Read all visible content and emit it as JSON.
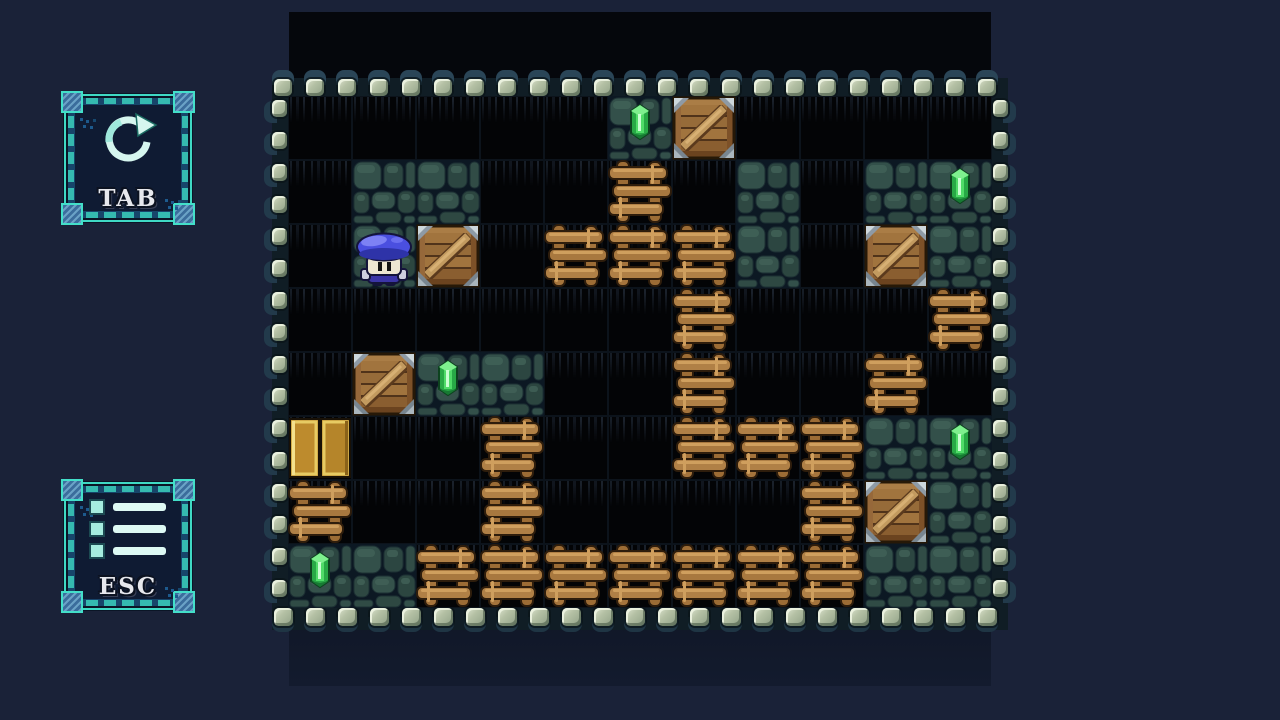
{
  "window": {
    "width": 1280,
    "height": 720,
    "background": "#1a2238"
  },
  "hud": {
    "restart_button": {
      "label": "TAB",
      "icon": "restart-icon"
    },
    "menu_button": {
      "label": "ESC",
      "icon": "menu-icon"
    }
  },
  "board": {
    "cols": 11,
    "rows": 8,
    "cell_size": 64,
    "origin": {
      "x": 288,
      "y": 96
    },
    "legend": {
      ".": "empty-floor",
      "c": "cobblestone-floor",
      "w": "wood-barrier",
      "K": "crate-on-empty",
      "C": "crate-on-cobble",
      "g": "gem-on-cobble",
      "P": "player-on-cobble",
      "D": "gold-door"
    },
    "tiles": [
      ".....gK....",
      ".cc..w.c.cg",
      ".PK.wwwc.Cc",
      "......w...w",
      ".Kgc..w..w.",
      "D..w..wwwcg",
      "w..w....wCc",
      "gcwwwwwwwcc"
    ],
    "counts": {
      "gems": 5,
      "crates": 5,
      "doors": 1
    }
  },
  "colors": {
    "page_background": "#1a2238",
    "void_black": "#05070c",
    "frame_teal": "#3fd9c4",
    "frame_blue": "#17456a",
    "corner_steel_blue": "#3b6d9c",
    "label_text": "#e7e8ed",
    "pebble_light": "#dde4cf",
    "pebble_mid": "#b4c0a4",
    "cobble_stone": "#33504a",
    "wood_log": "#a5743c",
    "crate_plank": "#a1743e",
    "crate_metal": "#8e9aa5",
    "gem_green": "#2fbf4f",
    "door_gold": "#bd8b2d",
    "player_cap_blue": "#4a4fe0",
    "player_face": "#eee7d2"
  }
}
